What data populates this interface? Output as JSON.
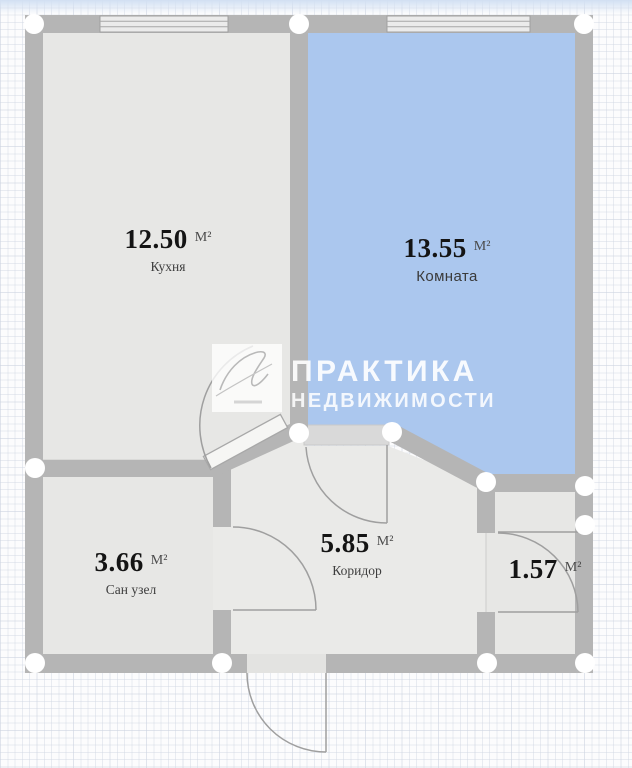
{
  "plan": {
    "watermark": {
      "line1": "ПРАКТИКА",
      "line2": "НЕДВИЖИМОСТИ"
    },
    "rooms": [
      {
        "id": "kitchen",
        "area": "12.50",
        "unit": "М²",
        "name": "Кухня"
      },
      {
        "id": "room",
        "area": "13.55",
        "unit": "М²",
        "name": "Комната"
      },
      {
        "id": "bathroom",
        "area": "3.66",
        "unit": "М²",
        "name": "Сан узел"
      },
      {
        "id": "corridor",
        "area": "5.85",
        "unit": "М²",
        "name": "Коридор"
      },
      {
        "id": "storage",
        "area": "1.57",
        "unit": "М²",
        "name": ""
      }
    ],
    "colors": {
      "wall": "#b5b5b5",
      "room_blue": "#abc7ee",
      "room_gray": "#e7e7e5",
      "corridor": "#eaeae8",
      "doorway": "#d9d9d9",
      "threshold": "#e3e3e1",
      "joint": "#ffffff",
      "arc_stroke": "#9f9f9f"
    }
  }
}
